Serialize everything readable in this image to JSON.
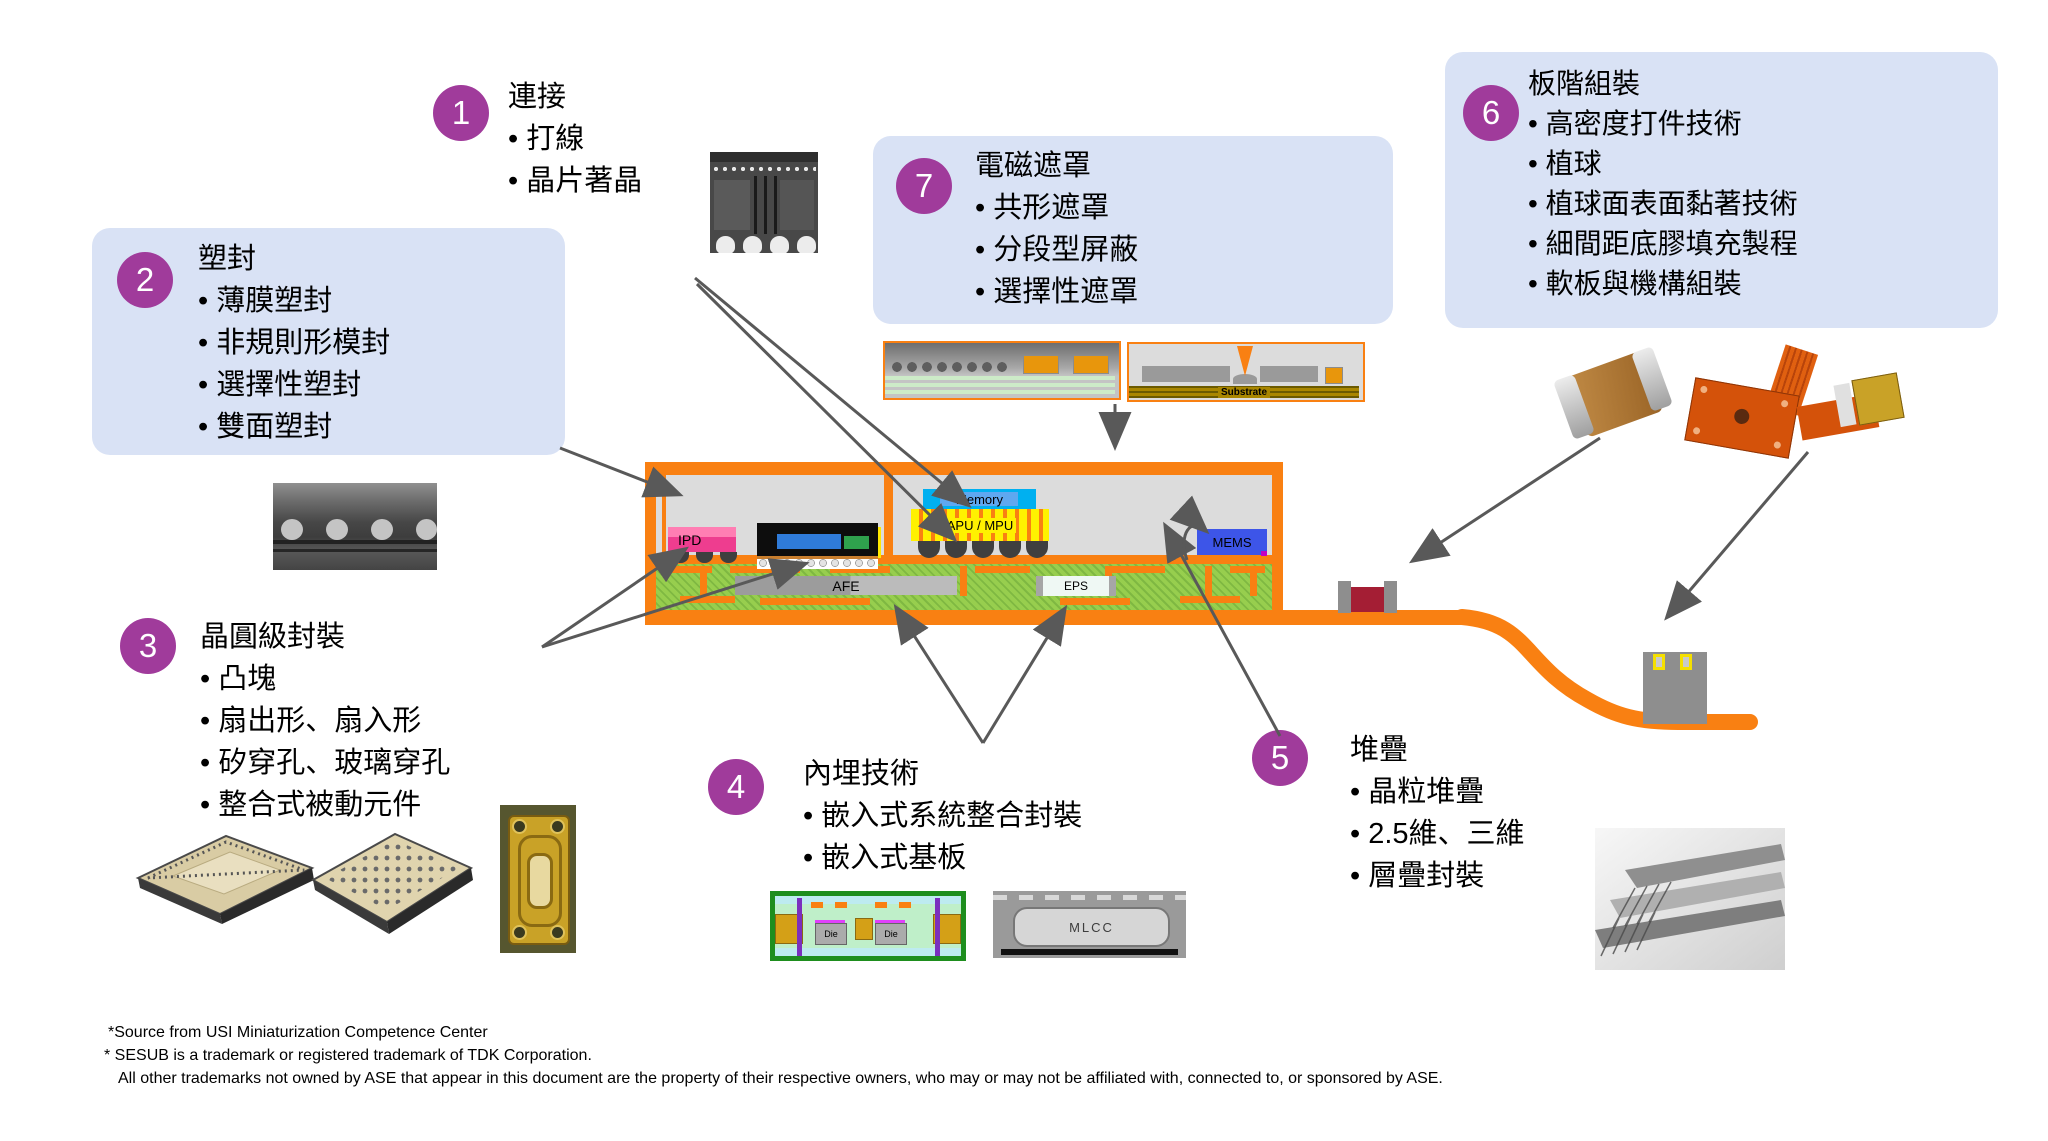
{
  "callouts": [
    {
      "number": "1",
      "title": "連接",
      "bullets": [
        "打線",
        "晶片著晶"
      ]
    },
    {
      "number": "2",
      "title": "塑封",
      "bullets": [
        "薄膜塑封",
        "非規則形模封",
        "選擇性塑封",
        "雙面塑封"
      ]
    },
    {
      "number": "3",
      "title": "晶圓級封裝",
      "bullets": [
        "凸塊",
        "扇出形、扇入形",
        "矽穿孔、玻璃穿孔",
        "整合式被動元件"
      ]
    },
    {
      "number": "4",
      "title": "內埋技術",
      "bullets": [
        "嵌入式系統整合封裝",
        "嵌入式基板"
      ]
    },
    {
      "number": "5",
      "title": "堆疊",
      "bullets": [
        "晶粒堆疊",
        "2.5維、三維",
        "層疊封裝"
      ]
    },
    {
      "number": "6",
      "title": "板階組裝",
      "bullets": [
        "高密度打件技術",
        "植球",
        "植球面表面黏著技術",
        "細間距底膠填充製程",
        "軟板與機構組裝"
      ]
    },
    {
      "number": "7",
      "title": "電磁遮罩",
      "bullets": [
        "共形遮罩",
        "分段型屏蔽",
        "選擇性遮罩"
      ]
    }
  ],
  "diagram": {
    "labels": {
      "ipd": "IPD",
      "memory": "Memory",
      "apu_mpu": "APU / MPU",
      "mems": "MEMS",
      "afe": "AFE",
      "eps": "EPS",
      "substrate": "Substrate",
      "die": "Die",
      "mlcc": "MLCC"
    }
  },
  "colors": {
    "accent_orange": "#F98012",
    "badge_purple": "#A03B9B",
    "callout_box": "#D9E2F5",
    "arrow_gray": "#595959",
    "substrate_green": "#8CC63F",
    "apu_yellow": "#FFF100",
    "memory_cyan": "#00B0F0",
    "mems_blue": "#3D55E8",
    "ipd_pink": "#F0539A"
  },
  "footnotes": [
    "*Source from USI Miniaturization Competence Center",
    "* SESUB is a trademark or registered trademark of TDK Corporation.",
    "All other trademarks not owned by ASE that appear in this document are the property of their respective owners, who may or may not be affiliated with, connected to, or sponsored by ASE."
  ]
}
